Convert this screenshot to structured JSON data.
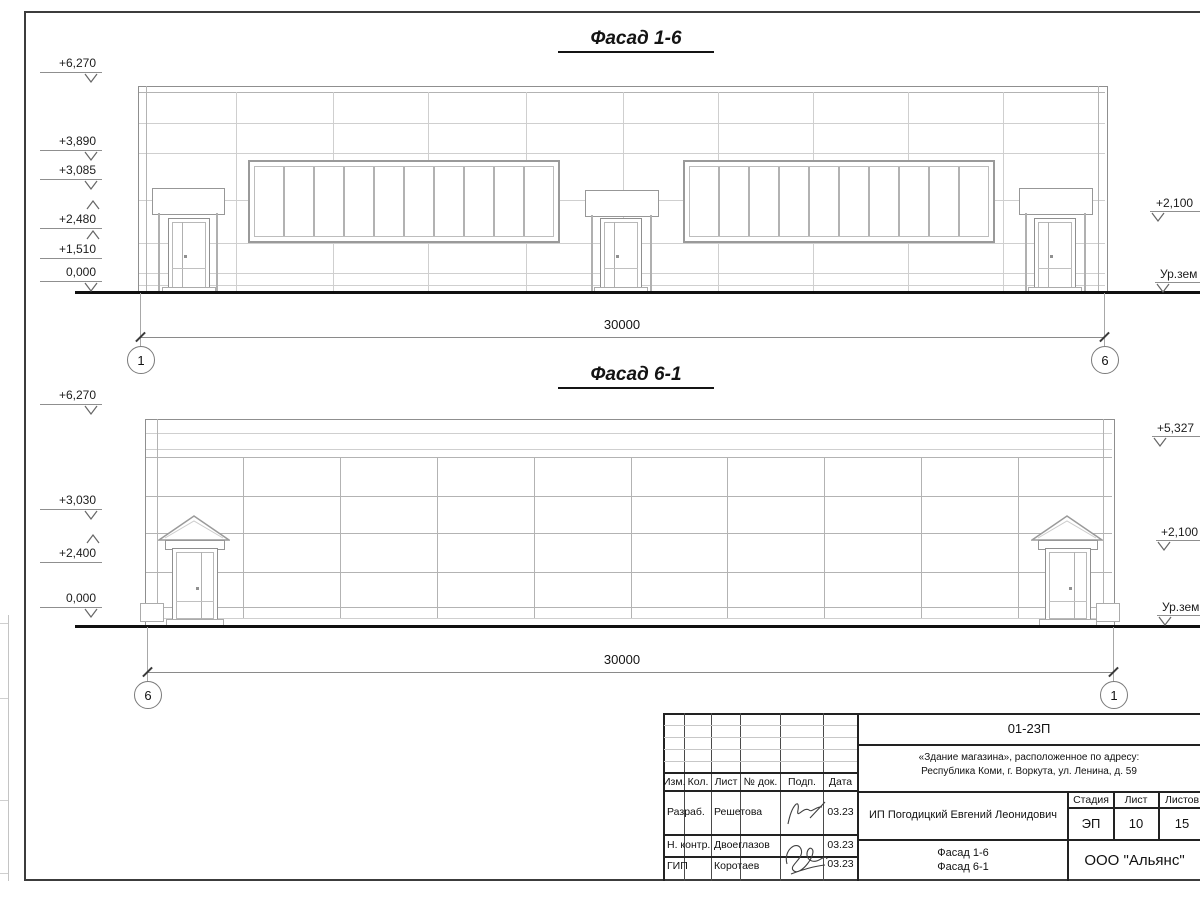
{
  "f16": {
    "title": "Фасад 1-6",
    "dim": "30000",
    "axis_left": "1",
    "axis_right": "6",
    "elev_left": [
      "+6,270",
      "+3,890",
      "+3,085",
      "+2,480",
      "+1,510",
      "0,000"
    ],
    "elev_right": [
      "+2,100",
      "Ур.зем"
    ]
  },
  "f61": {
    "title": "Фасад 6-1",
    "dim": "30000",
    "axis_left": "6",
    "axis_right": "1",
    "elev_left": [
      "+6,270",
      "+3,030",
      "+2,400",
      "0,000"
    ],
    "elev_right": [
      "+5,327",
      "+2,100",
      "Ур.зем"
    ]
  },
  "titleblock": {
    "doc_code": "01-23П",
    "object_line1": "«Здание магазина», расположенное по адресу:",
    "object_line2": "Республика Коми, г. Воркута, ул. Ленина, д. 59",
    "client": "ИП Погодицкий Евгений Леонидович",
    "stage_label": "Стадия",
    "sheet_label": "Лист",
    "sheets_label": "Листов",
    "stage": "ЭП",
    "sheet_no": "10",
    "sheets_total": "15",
    "content_line1": "Фасад 1-6",
    "content_line2": "Фасад 6-1",
    "company": "ООО \"Альянс\"",
    "col_izm": "Изм.",
    "col_kol": "Кол.",
    "col_list": "Лист",
    "col_ndok": "№ док.",
    "col_podp": "Подп.",
    "col_data": "Дата",
    "rows": [
      {
        "role": "Разраб.",
        "name": "Решетова",
        "date": "03.23"
      },
      {
        "role": "Н. контр.",
        "name": "Двоеглазов",
        "date": "03.23"
      },
      {
        "role": "ГИП",
        "name": "Коротаев",
        "date": "03.23"
      }
    ]
  }
}
